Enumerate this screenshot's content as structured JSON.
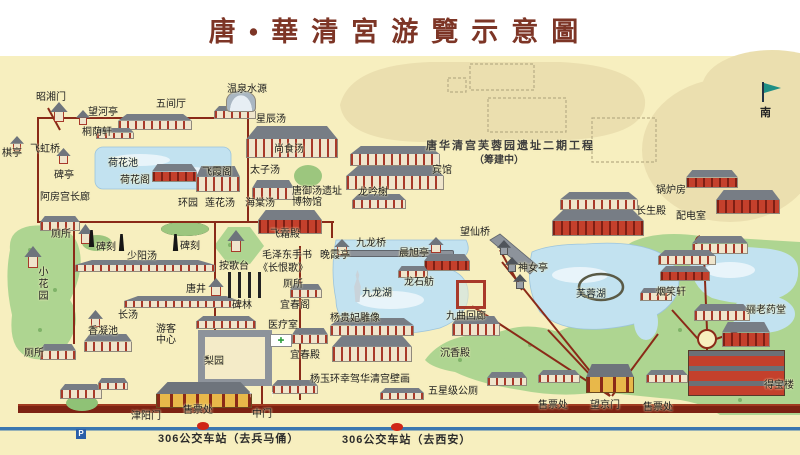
{
  "title": "唐•華清宮游覽示意圖",
  "compass": {
    "label": "南"
  },
  "colors": {
    "map_background": "#f7efbf",
    "title_text": "#7d3526",
    "road": "#8a2a18",
    "bottom_wall_road": "#7c2212",
    "bus_road_line": "#3a76b0",
    "water": "#c2e2f0",
    "green_area": "#aed591",
    "unexcavated_beige": "#ebdfaf",
    "bus_stop_dot": "#cf2517",
    "parking_icon_blue": "#2b5fa8"
  },
  "map": {
    "labels": [
      {
        "id": "zhaoxiang-gate",
        "text": "昭湘门",
        "x": 36,
        "y": 92
      },
      {
        "id": "wanghe-pavilion",
        "text": "望河亭",
        "x": 88,
        "y": 107
      },
      {
        "id": "wujian-hall",
        "text": "五间厅",
        "x": 156,
        "y": 99
      },
      {
        "id": "hot-spring-source",
        "text": "温泉水源",
        "x": 227,
        "y": 84
      },
      {
        "id": "xingchen-bath",
        "text": "星辰汤",
        "x": 256,
        "y": 114
      },
      {
        "id": "qi-pavilion",
        "text": "棋亭",
        "x": 2,
        "y": 148
      },
      {
        "id": "feihong-bridge",
        "text": "飞虹桥",
        "x": 30,
        "y": 144
      },
      {
        "id": "tongyin-xuan",
        "text": "桐荫轩",
        "x": 82,
        "y": 127
      },
      {
        "id": "bei-pavilion",
        "text": "碑亭",
        "x": 54,
        "y": 170
      },
      {
        "id": "lotus-pond",
        "text": "荷花池",
        "x": 108,
        "y": 158,
        "cls": "water"
      },
      {
        "id": "lotus-pavilion",
        "text": "荷花阁",
        "x": 120,
        "y": 175
      },
      {
        "id": "feixia-pavilion",
        "text": "飞霞阁",
        "x": 202,
        "y": 167
      },
      {
        "id": "efang-corridor",
        "text": "阿房宫长廊",
        "x": 40,
        "y": 192
      },
      {
        "id": "huan-garden",
        "text": "环园",
        "x": 178,
        "y": 198
      },
      {
        "id": "lianhua-bath",
        "text": "莲花汤",
        "x": 205,
        "y": 198
      },
      {
        "id": "haitang-bath",
        "text": "海棠汤",
        "x": 245,
        "y": 198
      },
      {
        "id": "tang-bath-museum",
        "text": "唐御汤遗址\n博物馆",
        "x": 292,
        "y": 186
      },
      {
        "id": "taizi-bath",
        "text": "太子汤",
        "x": 250,
        "y": 165
      },
      {
        "id": "shangshi-bath",
        "text": "尚食汤",
        "x": 274,
        "y": 144
      },
      {
        "id": "longyin-xie",
        "text": "龙吟榭",
        "x": 358,
        "y": 187
      },
      {
        "id": "hotel",
        "text": "宾馆",
        "x": 432,
        "y": 165
      },
      {
        "id": "phase2-project",
        "text": "唐华清宫芙蓉园遗址二期工程",
        "x": 426,
        "y": 141,
        "cls": "phase"
      },
      {
        "id": "phase2-note",
        "text": "（筹建中）",
        "x": 474,
        "y": 155,
        "cls": "note"
      },
      {
        "id": "boiler-room",
        "text": "锅炉房",
        "x": 656,
        "y": 185
      },
      {
        "id": "changsheng-hall",
        "text": "长生殿",
        "x": 636,
        "y": 206
      },
      {
        "id": "power-room",
        "text": "配电室",
        "x": 676,
        "y": 211
      },
      {
        "id": "toilet-1",
        "text": "厕所",
        "x": 51,
        "y": 229
      },
      {
        "id": "stele-1",
        "text": "碑刻",
        "x": 96,
        "y": 242
      },
      {
        "id": "stele-2",
        "text": "碑刻",
        "x": 180,
        "y": 241
      },
      {
        "id": "shaoyang-bath",
        "text": "少阳汤",
        "x": 127,
        "y": 251
      },
      {
        "id": "ange-terrace",
        "text": "按歌台",
        "x": 219,
        "y": 261
      },
      {
        "id": "small-garden",
        "text": "小花园",
        "x": 36,
        "y": 266,
        "v": true
      },
      {
        "id": "tang-well",
        "text": "唐井",
        "x": 186,
        "y": 284
      },
      {
        "id": "stele-forest",
        "text": "碑林",
        "x": 232,
        "y": 300
      },
      {
        "id": "feishuang-hall",
        "text": "飞霜殿",
        "x": 270,
        "y": 229
      },
      {
        "id": "mao-calligraphy",
        "text": "毛泽东手书",
        "x": 262,
        "y": 250
      },
      {
        "id": "changhen-ge",
        "text": "《长恨歌》",
        "x": 258,
        "y": 263
      },
      {
        "id": "toilet-2",
        "text": "厕所",
        "x": 283,
        "y": 279
      },
      {
        "id": "yichun-pavilion",
        "text": "宜春阁",
        "x": 280,
        "y": 300
      },
      {
        "id": "medical-room",
        "text": "医疗室",
        "x": 268,
        "y": 320
      },
      {
        "id": "yichun-hall",
        "text": "宜春殿",
        "x": 290,
        "y": 350
      },
      {
        "id": "wanxia-pavilion",
        "text": "晚霞亭",
        "x": 320,
        "y": 250
      },
      {
        "id": "jiulong-bridge",
        "text": "九龙桥",
        "x": 356,
        "y": 238
      },
      {
        "id": "chenxu-pavilion",
        "text": "晨旭亭",
        "x": 399,
        "y": 248
      },
      {
        "id": "wangxian-bridge",
        "text": "望仙桥",
        "x": 460,
        "y": 227
      },
      {
        "id": "longshi-boat",
        "text": "龙石舫",
        "x": 404,
        "y": 277
      },
      {
        "id": "jiulong-lake",
        "text": "九龙湖",
        "x": 362,
        "y": 288,
        "cls": "water"
      },
      {
        "id": "yangguifei-statue",
        "text": "杨贵妃雕像",
        "x": 330,
        "y": 313
      },
      {
        "id": "jiuqu-corridor",
        "text": "九曲回廊",
        "x": 446,
        "y": 311
      },
      {
        "id": "shennv-pavilion",
        "text": "神女亭",
        "x": 518,
        "y": 263
      },
      {
        "id": "furong-lake",
        "text": "芙蓉湖",
        "x": 576,
        "y": 289,
        "cls": "water"
      },
      {
        "id": "yanxiao-xuan",
        "text": "烟笑轩",
        "x": 656,
        "y": 287
      },
      {
        "id": "lilao-pharmacy",
        "text": "骊老药堂",
        "x": 746,
        "y": 305
      },
      {
        "id": "chenxiang-hall",
        "text": "沉香殿",
        "x": 440,
        "y": 348
      },
      {
        "id": "mural",
        "text": "杨玉环幸驾华清宫壁画",
        "x": 310,
        "y": 374
      },
      {
        "id": "five-star-toilet",
        "text": "五星级公厕",
        "x": 428,
        "y": 386
      },
      {
        "id": "debao-tower",
        "text": "得宝楼",
        "x": 764,
        "y": 380
      },
      {
        "id": "visitor-center",
        "text": "游客\n中心",
        "x": 156,
        "y": 324
      },
      {
        "id": "pear-garden",
        "text": "梨园",
        "x": 204,
        "y": 356
      },
      {
        "id": "chang-bath",
        "text": "长汤",
        "x": 118,
        "y": 310
      },
      {
        "id": "xiangning-pond",
        "text": "香凝池",
        "x": 88,
        "y": 326
      },
      {
        "id": "toilet-3",
        "text": "厕所",
        "x": 24,
        "y": 348
      },
      {
        "id": "ticket-office-1",
        "text": "售票处",
        "x": 183,
        "y": 405
      },
      {
        "id": "jinyang-gate",
        "text": "津阳门",
        "x": 131,
        "y": 411
      },
      {
        "id": "middle-gate",
        "text": "中门",
        "x": 252,
        "y": 409
      },
      {
        "id": "ticket-office-2",
        "text": "售票处",
        "x": 538,
        "y": 400
      },
      {
        "id": "wangjing-gate",
        "text": "望京门",
        "x": 590,
        "y": 400
      },
      {
        "id": "ticket-office-3",
        "text": "售票处",
        "x": 643,
        "y": 402
      },
      {
        "id": "gate-arrow-1",
        "text": "↑",
        "x": 248,
        "y": 389,
        "cls": "arrow"
      },
      {
        "id": "gate-arrow-2",
        "text": "↑",
        "x": 270,
        "y": 389,
        "cls": "arrow"
      }
    ],
    "buildings": [
      {
        "icon": "hall-icon",
        "variant": "",
        "x": 118,
        "y": 114,
        "w": 74,
        "h": 16
      },
      {
        "icon": "hall-icon",
        "variant": "",
        "x": 96,
        "y": 128,
        "w": 38,
        "h": 11
      },
      {
        "icon": "gate-tower-icon",
        "variant": "pavilion",
        "x": 50,
        "y": 102,
        "w": 18,
        "h": 20
      },
      {
        "icon": "pavilion-icon",
        "variant": "pavilion",
        "x": 76,
        "y": 110,
        "w": 14,
        "h": 15
      },
      {
        "icon": "pavilion-icon",
        "variant": "pavilion",
        "x": 10,
        "y": 136,
        "w": 14,
        "h": 15
      },
      {
        "icon": "pavilion-icon",
        "variant": "pavilion",
        "x": 56,
        "y": 148,
        "w": 15,
        "h": 16
      },
      {
        "icon": "hall-icon",
        "variant": "",
        "x": 214,
        "y": 106,
        "w": 42,
        "h": 13
      },
      {
        "icon": "hall-icon",
        "variant": "red",
        "x": 152,
        "y": 164,
        "w": 45,
        "h": 18
      },
      {
        "icon": "spring-dome-icon",
        "variant": "dome",
        "x": 226,
        "y": 90,
        "w": 30,
        "h": 22
      },
      {
        "icon": "hall-icon",
        "variant": "",
        "x": 246,
        "y": 126,
        "w": 92,
        "h": 32
      },
      {
        "icon": "hall-icon",
        "variant": "",
        "x": 196,
        "y": 166,
        "w": 44,
        "h": 26
      },
      {
        "icon": "hall-icon",
        "variant": "",
        "x": 252,
        "y": 180,
        "w": 42,
        "h": 20
      },
      {
        "icon": "hall-icon",
        "variant": "red",
        "x": 258,
        "y": 210,
        "w": 64,
        "h": 24
      },
      {
        "icon": "hall-icon",
        "variant": "",
        "x": 350,
        "y": 146,
        "w": 90,
        "h": 20
      },
      {
        "icon": "hall-icon",
        "variant": "",
        "x": 346,
        "y": 166,
        "w": 98,
        "h": 24
      },
      {
        "icon": "hall-icon",
        "variant": "",
        "x": 352,
        "y": 194,
        "w": 54,
        "h": 15
      },
      {
        "icon": "hall-icon",
        "variant": "",
        "x": 560,
        "y": 192,
        "w": 78,
        "h": 18
      },
      {
        "icon": "hall-icon",
        "variant": "red",
        "x": 552,
        "y": 210,
        "w": 92,
        "h": 26
      },
      {
        "icon": "hall-icon",
        "variant": "red",
        "x": 686,
        "y": 170,
        "w": 52,
        "h": 18
      },
      {
        "icon": "hall-icon",
        "variant": "red",
        "x": 716,
        "y": 190,
        "w": 64,
        "h": 24
      },
      {
        "icon": "hall-icon",
        "variant": "",
        "x": 692,
        "y": 236,
        "w": 56,
        "h": 18
      },
      {
        "icon": "hall-icon",
        "variant": "",
        "x": 658,
        "y": 250,
        "w": 58,
        "h": 15
      },
      {
        "icon": "hall-icon",
        "variant": "red",
        "x": 660,
        "y": 266,
        "w": 50,
        "h": 15
      },
      {
        "icon": "hall-icon",
        "variant": "",
        "x": 640,
        "y": 288,
        "w": 32,
        "h": 13
      },
      {
        "icon": "hall-icon",
        "variant": "",
        "x": 694,
        "y": 304,
        "w": 56,
        "h": 17
      },
      {
        "icon": "hall-icon",
        "variant": "red",
        "x": 722,
        "y": 322,
        "w": 48,
        "h": 25
      },
      {
        "icon": "tower-icon",
        "variant": "tower",
        "x": 688,
        "y": 350,
        "w": 97,
        "h": 46
      },
      {
        "icon": "hall-icon",
        "variant": "",
        "x": 40,
        "y": 216,
        "w": 40,
        "h": 15
      },
      {
        "icon": "pavilion-icon",
        "variant": "pavilion",
        "x": 78,
        "y": 224,
        "w": 15,
        "h": 20
      },
      {
        "icon": "pavilion-icon",
        "variant": "pavilion",
        "x": 24,
        "y": 246,
        "w": 18,
        "h": 22
      },
      {
        "icon": "pavilion-icon",
        "variant": "pavilion",
        "x": 88,
        "y": 310,
        "w": 15,
        "h": 17
      },
      {
        "icon": "hall-icon",
        "variant": "",
        "x": 84,
        "y": 334,
        "w": 48,
        "h": 18
      },
      {
        "icon": "hall-icon",
        "variant": "",
        "x": 40,
        "y": 344,
        "w": 36,
        "h": 16
      },
      {
        "icon": "corridor-icon",
        "variant": "",
        "x": 75,
        "y": 260,
        "w": 140,
        "h": 12
      },
      {
        "icon": "corridor-icon",
        "variant": "",
        "x": 124,
        "y": 296,
        "w": 116,
        "h": 12
      },
      {
        "icon": "pavilion-icon",
        "variant": "pavilion",
        "x": 227,
        "y": 230,
        "w": 18,
        "h": 22
      },
      {
        "icon": "pavilion-icon",
        "variant": "pavilion",
        "x": 208,
        "y": 278,
        "w": 16,
        "h": 18
      },
      {
        "icon": "hall-icon",
        "variant": "",
        "x": 196,
        "y": 316,
        "w": 60,
        "h": 13
      },
      {
        "icon": "courtyard-icon",
        "variant": "courtyard-gray",
        "x": 198,
        "y": 330,
        "w": 74,
        "h": 56
      },
      {
        "icon": "hall-icon",
        "variant": "",
        "x": 330,
        "y": 318,
        "w": 84,
        "h": 18
      },
      {
        "icon": "hall-icon",
        "variant": "",
        "x": 332,
        "y": 336,
        "w": 80,
        "h": 26
      },
      {
        "icon": "hall-icon",
        "variant": "",
        "x": 452,
        "y": 316,
        "w": 48,
        "h": 20
      },
      {
        "icon": "clinic-icon",
        "variant": "clinic",
        "x": 270,
        "y": 334,
        "w": 22,
        "h": 13
      },
      {
        "icon": "hall-icon",
        "variant": "",
        "x": 292,
        "y": 328,
        "w": 36,
        "h": 16
      },
      {
        "icon": "hall-icon",
        "variant": "",
        "x": 290,
        "y": 284,
        "w": 32,
        "h": 14
      },
      {
        "icon": "hall-icon",
        "variant": "",
        "x": 60,
        "y": 384,
        "w": 42,
        "h": 15
      },
      {
        "icon": "hall-icon",
        "variant": "",
        "x": 98,
        "y": 378,
        "w": 30,
        "h": 12
      },
      {
        "icon": "gate-icon",
        "variant": "gate",
        "x": 156,
        "y": 382,
        "w": 96,
        "h": 26
      },
      {
        "icon": "hall-icon",
        "variant": "",
        "x": 272,
        "y": 380,
        "w": 46,
        "h": 14
      },
      {
        "icon": "hall-icon",
        "variant": "",
        "x": 380,
        "y": 388,
        "w": 44,
        "h": 12
      },
      {
        "icon": "hall-icon",
        "variant": "",
        "x": 487,
        "y": 372,
        "w": 40,
        "h": 14
      },
      {
        "icon": "hall-icon",
        "variant": "",
        "x": 538,
        "y": 370,
        "w": 42,
        "h": 13
      },
      {
        "icon": "gate-icon",
        "variant": "gate",
        "x": 586,
        "y": 364,
        "w": 48,
        "h": 29
      },
      {
        "icon": "hall-icon",
        "variant": "",
        "x": 646,
        "y": 370,
        "w": 42,
        "h": 13
      },
      {
        "icon": "bridge-icon",
        "variant": "bridge",
        "x": 338,
        "y": 250,
        "w": 116,
        "h": 7
      },
      {
        "icon": "pavilion-icon",
        "variant": "pavilion",
        "x": 334,
        "y": 239,
        "w": 16,
        "h": 16
      },
      {
        "icon": "pavilion-icon",
        "variant": "pavilion",
        "x": 428,
        "y": 237,
        "w": 16,
        "h": 16
      },
      {
        "icon": "hall-icon",
        "variant": "red",
        "x": 424,
        "y": 254,
        "w": 46,
        "h": 17
      },
      {
        "icon": "boat-hall-icon",
        "variant": "",
        "x": 398,
        "y": 266,
        "w": 30,
        "h": 12
      },
      {
        "icon": "corridor-court-icon",
        "variant": "courtyard",
        "x": 456,
        "y": 280,
        "w": 30,
        "h": 29
      },
      {
        "icon": "pavilion-icon",
        "variant": "pavilion dark",
        "x": 497,
        "y": 240,
        "w": 14,
        "h": 15
      },
      {
        "icon": "pavilion-icon",
        "variant": "pavilion dark",
        "x": 505,
        "y": 257,
        "w": 14,
        "h": 15
      },
      {
        "icon": "pavilion-icon",
        "variant": "pavilion dark",
        "x": 513,
        "y": 274,
        "w": 14,
        "h": 15
      },
      {
        "icon": "obelisk-icon",
        "variant": "obelisk",
        "x": 88,
        "y": 230,
        "w": 7,
        "h": 17
      },
      {
        "icon": "obelisk-icon",
        "variant": "obelisk",
        "x": 118,
        "y": 234,
        "w": 7,
        "h": 17
      },
      {
        "icon": "obelisk-icon",
        "variant": "obelisk",
        "x": 172,
        "y": 234,
        "w": 7,
        "h": 17
      },
      {
        "icon": "statue-icon",
        "variant": "statue",
        "x": 351,
        "y": 270,
        "w": 13,
        "h": 32
      },
      {
        "icon": "stele-columns-icon",
        "variant": "columns",
        "x": 228,
        "y": 272,
        "w": 34,
        "h": 26
      }
    ],
    "bus_line": {
      "stops": [
        {
          "label": "306公交车站（去兵马俑）",
          "label_x": 158,
          "label_y": 434,
          "dot_x": 197,
          "dot_y": 422
        },
        {
          "label": "306公交车站（去西安）",
          "label_x": 342,
          "label_y": 435,
          "dot_x": 391,
          "dot_y": 423
        }
      ],
      "parking": {
        "label": "P",
        "x": 76,
        "y": 429
      }
    }
  }
}
